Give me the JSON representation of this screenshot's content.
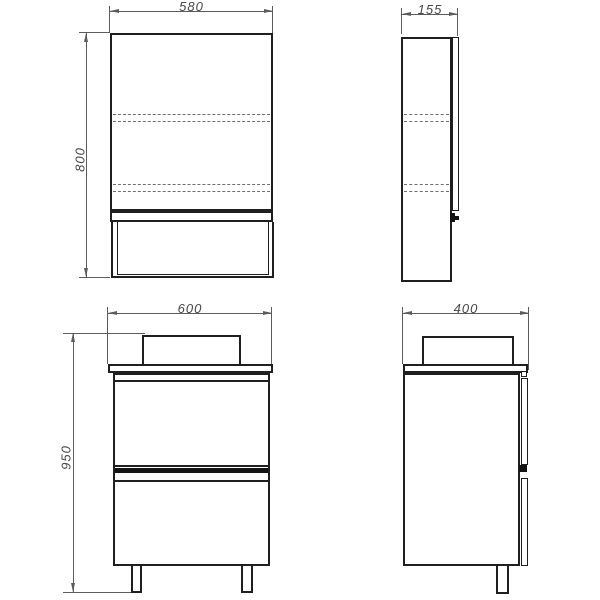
{
  "drawing": {
    "mirror_front": {
      "width": "580",
      "height": "800"
    },
    "mirror_side": {
      "depth": "155"
    },
    "vanity_front": {
      "width": "600",
      "height": "950"
    },
    "vanity_side": {
      "depth": "400"
    },
    "colors": {
      "object_line": "#1f1f1f",
      "dimension_line": "#5c5c5c",
      "dashed_line": "#6f6f6f",
      "text": "#474747",
      "background": "#ffffff",
      "handle_fill": "#141414"
    }
  }
}
